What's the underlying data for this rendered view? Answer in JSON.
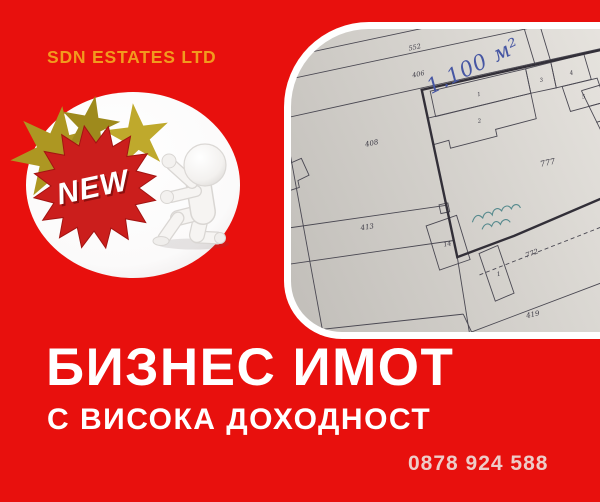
{
  "brand": {
    "name": "SDN ESTATES LTD"
  },
  "badge": {
    "label": "NEW"
  },
  "headline": {
    "title": "БИЗНЕС ИМОТ",
    "subtitle": "С ВИСОКА ДОХОДНОСТ"
  },
  "contact": {
    "phone": "0878 924 588"
  },
  "map_photo": {
    "handwritten_area": "1.100 м²",
    "parcel_labels": [
      "552",
      "406",
      "408",
      "413",
      "777",
      "14",
      "772",
      "419",
      "1"
    ],
    "lot_numbers": [
      "1",
      "2",
      "3",
      "4",
      "5",
      "6",
      "7",
      "8",
      "9",
      "10",
      "11",
      "12"
    ]
  },
  "colors": {
    "background_red": "#e8100d",
    "brand_orange": "#f29a1e",
    "headline_white": "#ffffff",
    "phone_pink": "#eeccc8",
    "starburst_red": "#cb1e1c",
    "star_gold": "#ad9722",
    "paper_gray": "#d5d2cd",
    "plan_ink": "#4a4852",
    "handwriting_blue": "#4656a3"
  }
}
